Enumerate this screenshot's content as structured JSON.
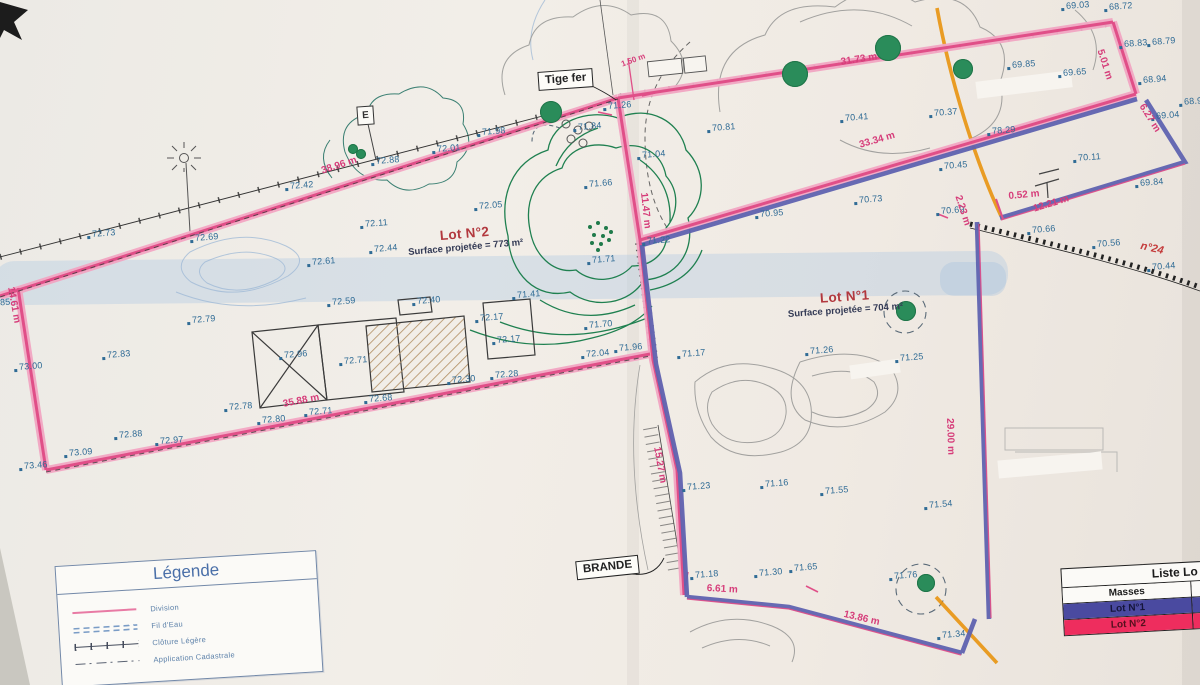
{
  "document": {
    "type": "Plan de division (scan géomètre)"
  },
  "colors": {
    "division_pink_band": "#f2a6c3",
    "division_pink_core": "#e04f88",
    "lot_line_blue": "#5f63b0",
    "elevation_blue": "#2f6b95",
    "measurement_pink": "#d63d7a",
    "tree_green": "#2a8c5a",
    "orange_mark": "#e8940f",
    "paper": "#f0ece6"
  },
  "legend": {
    "title": "Légende",
    "items": [
      {
        "label": "Division",
        "symbol": "pink-line"
      },
      {
        "label": "Fil d'Eau",
        "symbol": "blue-dashed-double"
      },
      {
        "label": "Clôture Légère",
        "symbol": "ticked-line"
      },
      {
        "label": "Application Cadastrale",
        "symbol": "dash-dot-line"
      }
    ]
  },
  "masses_table": {
    "title": "Liste Lo",
    "header": "Masses",
    "rows": [
      {
        "label": "Lot N°1",
        "color": "#4a4aa0"
      },
      {
        "label": "Lot N°2",
        "color": "#ee2d5e"
      }
    ]
  },
  "lots": [
    {
      "name": "Lot N°2",
      "surface": "Surface projetée = 773 m²"
    },
    {
      "name": "Lot N°1",
      "surface": "Surface projetée = 704 m²"
    }
  ],
  "annotations": {
    "tige_fer": "Tige fer",
    "brande": "BRANDE",
    "e_pole": "E"
  },
  "plan": {
    "measurements": [
      {
        "t": "38.96 m",
        "x": 320,
        "y": 166,
        "r": -18
      },
      {
        "t": "14.61 m",
        "x": 16,
        "y": 286,
        "r": 80
      },
      {
        "t": "35.88 m",
        "x": 282,
        "y": 399,
        "r": -11
      },
      {
        "t": "31.73 m",
        "x": 840,
        "y": 57,
        "r": -9
      },
      {
        "t": "33.34 m",
        "x": 858,
        "y": 140,
        "r": -16
      },
      {
        "t": "5.01 m",
        "x": 1105,
        "y": 48,
        "r": 72
      },
      {
        "t": "6.27 m",
        "x": 1146,
        "y": 102,
        "r": 58
      },
      {
        "t": "12.21 m",
        "x": 1032,
        "y": 204,
        "r": -17
      },
      {
        "t": "2.23 m",
        "x": 963,
        "y": 194,
        "r": 72
      },
      {
        "t": "0.52 m",
        "x": 1008,
        "y": 191,
        "r": -5
      },
      {
        "t": "11.47 m",
        "x": 649,
        "y": 192,
        "r": 84
      },
      {
        "t": "15.27 m",
        "x": 662,
        "y": 446,
        "r": 80
      },
      {
        "t": "6.61 m",
        "x": 707,
        "y": 583,
        "r": 3
      },
      {
        "t": "13.86 m",
        "x": 845,
        "y": 609,
        "r": 13
      },
      {
        "t": "29.00 m",
        "x": 955,
        "y": 418,
        "r": 88
      },
      {
        "t": "1.50 m",
        "x": 620,
        "y": 60,
        "r": -20,
        "cls": "small"
      },
      {
        "t": "n°24",
        "x": 1142,
        "y": 240,
        "r": 13,
        "cls": "road-label"
      }
    ],
    "elevations": [
      {
        "v": "68.72",
        "x": 1109,
        "y": 1
      },
      {
        "v": "69.03",
        "x": 1066,
        "y": 0
      },
      {
        "v": "68.83",
        "x": 1124,
        "y": 38
      },
      {
        "v": "68.79",
        "x": 1152,
        "y": 36
      },
      {
        "v": "68.94",
        "x": 1143,
        "y": 74
      },
      {
        "v": "68.9",
        "x": 1184,
        "y": 96
      },
      {
        "v": "69.04",
        "x": 1156,
        "y": 110
      },
      {
        "v": "69.85",
        "x": 1012,
        "y": 59
      },
      {
        "v": "69.65",
        "x": 1063,
        "y": 67
      },
      {
        "v": "69.84",
        "x": 1140,
        "y": 177
      },
      {
        "v": "70.11",
        "x": 1078,
        "y": 152
      },
      {
        "v": "70.56",
        "x": 1097,
        "y": 238
      },
      {
        "v": "70.44",
        "x": 1152,
        "y": 261
      },
      {
        "v": "70.37",
        "x": 934,
        "y": 107
      },
      {
        "v": "70.45",
        "x": 944,
        "y": 160
      },
      {
        "v": "78.29",
        "x": 992,
        "y": 125
      },
      {
        "v": "70.66",
        "x": 1032,
        "y": 224
      },
      {
        "v": "70.69",
        "x": 941,
        "y": 205
      },
      {
        "v": "70.41",
        "x": 845,
        "y": 112
      },
      {
        "v": "70.81",
        "x": 712,
        "y": 122
      },
      {
        "v": "70.95",
        "x": 760,
        "y": 208
      },
      {
        "v": "70.73",
        "x": 859,
        "y": 194
      },
      {
        "v": "71.98",
        "x": 482,
        "y": 126
      },
      {
        "v": "72.01",
        "x": 437,
        "y": 143
      },
      {
        "v": "72.88",
        "x": 376,
        "y": 155
      },
      {
        "v": "72.42",
        "x": 290,
        "y": 180
      },
      {
        "v": "72.05",
        "x": 479,
        "y": 200
      },
      {
        "v": "71.84",
        "x": 578,
        "y": 121
      },
      {
        "v": "71.26",
        "x": 608,
        "y": 100
      },
      {
        "v": "71.04",
        "x": 642,
        "y": 149
      },
      {
        "v": "71.66",
        "x": 589,
        "y": 178
      },
      {
        "v": "71.22",
        "x": 647,
        "y": 235
      },
      {
        "v": "71.71",
        "x": 592,
        "y": 254
      },
      {
        "v": "71.70",
        "x": 589,
        "y": 319
      },
      {
        "v": "71.96",
        "x": 619,
        "y": 342
      },
      {
        "v": "72.04",
        "x": 586,
        "y": 348
      },
      {
        "v": "71.17",
        "x": 682,
        "y": 348
      },
      {
        "v": "71.41",
        "x": 517,
        "y": 289
      },
      {
        "v": "72.11",
        "x": 365,
        "y": 218
      },
      {
        "v": "72.44",
        "x": 374,
        "y": 243
      },
      {
        "v": "72.69",
        "x": 195,
        "y": 232
      },
      {
        "v": "72.73",
        "x": 92,
        "y": 228
      },
      {
        "v": "72.61",
        "x": 312,
        "y": 256
      },
      {
        "v": "72.79",
        "x": 192,
        "y": 314
      },
      {
        "v": "72.83",
        "x": 107,
        "y": 349
      },
      {
        "v": "73.00",
        "x": 19,
        "y": 361
      },
      {
        "v": "72.59",
        "x": 332,
        "y": 296
      },
      {
        "v": "72.40",
        "x": 417,
        "y": 295
      },
      {
        "v": "72.17",
        "x": 480,
        "y": 312
      },
      {
        "v": "72.17",
        "x": 497,
        "y": 334
      },
      {
        "v": "72.96",
        "x": 284,
        "y": 349
      },
      {
        "v": "72.71",
        "x": 344,
        "y": 355
      },
      {
        "v": "72.30",
        "x": 452,
        "y": 374
      },
      {
        "v": "72.28",
        "x": 495,
        "y": 369
      },
      {
        "v": "72.68",
        "x": 369,
        "y": 393
      },
      {
        "v": "72.78",
        "x": 229,
        "y": 401
      },
      {
        "v": "72.71",
        "x": 309,
        "y": 406
      },
      {
        "v": "72.80",
        "x": 262,
        "y": 414
      },
      {
        "v": "73.09",
        "x": 69,
        "y": 447
      },
      {
        "v": "72.88",
        "x": 119,
        "y": 429
      },
      {
        "v": "72.97",
        "x": 160,
        "y": 435
      },
      {
        "v": "73.46",
        "x": 24,
        "y": 460
      },
      {
        "v": "85",
        "x": 0,
        "y": 297
      },
      {
        "v": "71.25",
        "x": 900,
        "y": 352
      },
      {
        "v": "71.26",
        "x": 810,
        "y": 345
      },
      {
        "v": "71.23",
        "x": 687,
        "y": 481
      },
      {
        "v": "71.16",
        "x": 765,
        "y": 478
      },
      {
        "v": "71.55",
        "x": 825,
        "y": 485
      },
      {
        "v": "71.54",
        "x": 929,
        "y": 499
      },
      {
        "v": "71.18",
        "x": 695,
        "y": 569
      },
      {
        "v": "71.30",
        "x": 759,
        "y": 567
      },
      {
        "v": "71.65",
        "x": 794,
        "y": 562
      },
      {
        "v": "71.76",
        "x": 894,
        "y": 570
      },
      {
        "v": "71.34",
        "x": 942,
        "y": 629
      }
    ],
    "trees": [
      {
        "x": 551,
        "y": 112,
        "r": 11
      },
      {
        "x": 795,
        "y": 74,
        "r": 13
      },
      {
        "x": 888,
        "y": 48,
        "r": 13
      },
      {
        "x": 963,
        "y": 69,
        "r": 10
      },
      {
        "x": 906,
        "y": 311,
        "r": 10
      },
      {
        "x": 926,
        "y": 583,
        "r": 9
      },
      {
        "x": 353,
        "y": 149,
        "r": 5
      },
      {
        "x": 361,
        "y": 154,
        "r": 5
      }
    ],
    "seed_dots": [
      {
        "x": 588,
        "y": 225
      },
      {
        "x": 596,
        "y": 221
      },
      {
        "x": 604,
        "y": 226
      },
      {
        "x": 592,
        "y": 233
      },
      {
        "x": 601,
        "y": 234
      },
      {
        "x": 609,
        "y": 230
      },
      {
        "x": 590,
        "y": 241
      },
      {
        "x": 599,
        "y": 242
      },
      {
        "x": 607,
        "y": 238
      },
      {
        "x": 596,
        "y": 248
      }
    ]
  }
}
